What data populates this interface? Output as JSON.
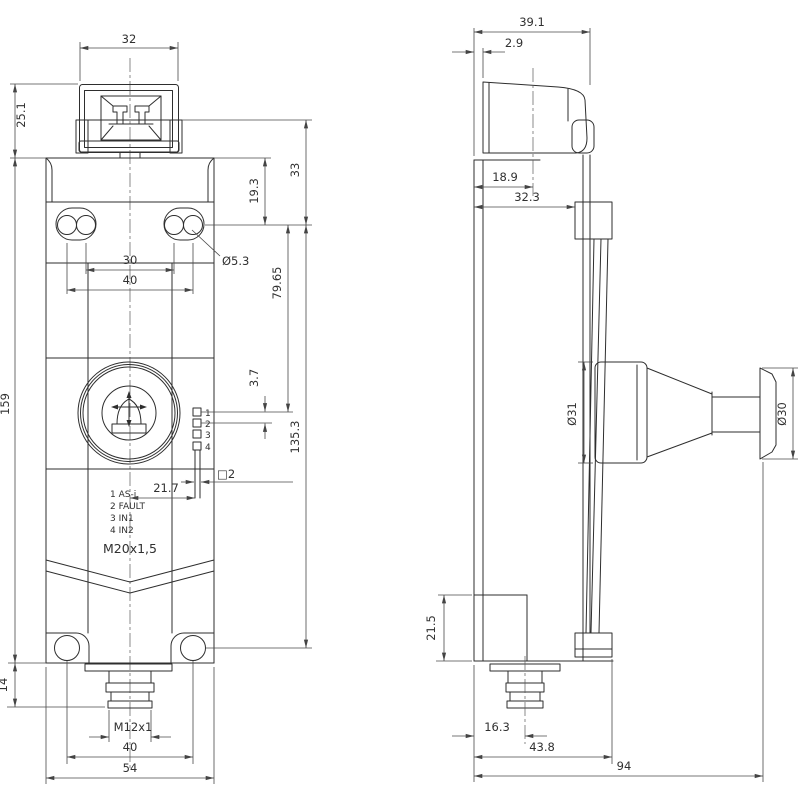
{
  "front": {
    "dims": {
      "width_top": "32",
      "connector_height": "25.1",
      "body_height": "159",
      "bottom_stub": "14",
      "hole_offset": "19.3",
      "top_offset": "33",
      "hole_dia": "Ø5.3",
      "hole_span_inner": "30",
      "hole_span_outer": "40",
      "led_offset": "79.65",
      "led_pitch": "3.7",
      "hole_span_vertical": "135.3",
      "led_x": "21.7",
      "led_size": "□2",
      "gland_thread": "M20x1,5",
      "plug_thread": "M12x1",
      "hole_span_bottom": "40",
      "width": "54"
    },
    "led_numbers": [
      "1",
      "2",
      "3",
      "4"
    ],
    "legend": [
      "1 AS-i",
      "2 FAULT",
      "3 IN1",
      "4 IN2"
    ]
  },
  "side": {
    "dims": {
      "depth_top": "39.1",
      "plate_gap": "2.9",
      "head_center": "18.9",
      "block_offset": "32.3",
      "knob_dia": "Ø31",
      "cap_dia": "Ø30",
      "bracket_height": "21.5",
      "plug_center": "16.3",
      "body_depth": "43.8",
      "total_depth": "94"
    }
  }
}
